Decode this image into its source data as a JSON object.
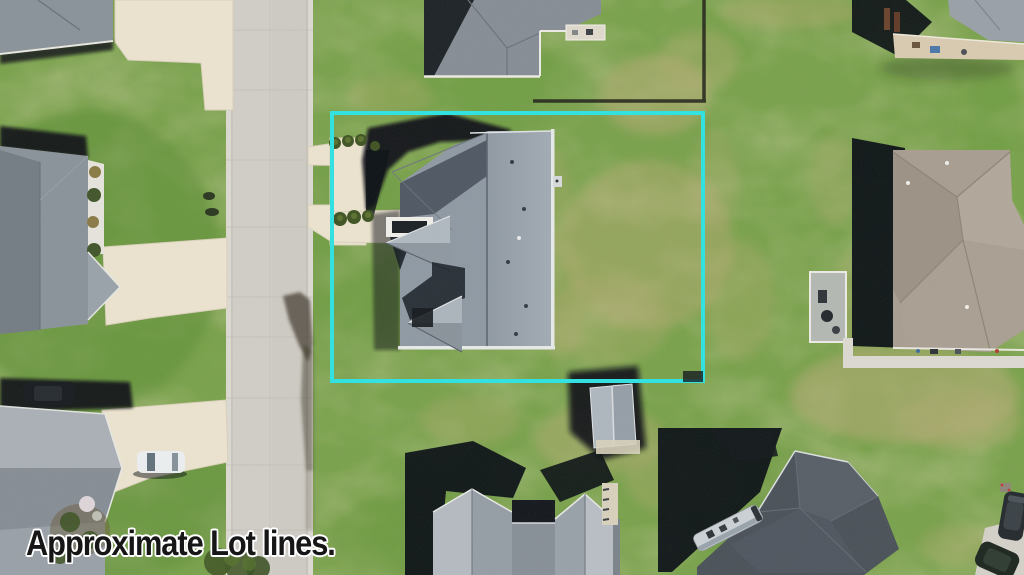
{
  "image": {
    "type": "aerial-drone-photograph",
    "caption": "Approximate Lot lines.",
    "lot_boundary": {
      "shape": "rectangle",
      "color": "#2de2e2"
    },
    "scene_objects": [
      "street",
      "subject-house",
      "subject-lot-yard",
      "storage-shed",
      "neighbor-house-top-left",
      "neighbor-house-left",
      "neighbor-house-bottom-left",
      "neighbor-house-top",
      "neighbor-house-top-right",
      "neighbor-house-right",
      "neighbor-house-bottom-center",
      "neighbor-house-bottom-right",
      "white-car",
      "dark-car",
      "rv-camper",
      "parked-suv",
      "parked-car",
      "backyard-fence",
      "street-tree",
      "shrub-rows",
      "driveways"
    ],
    "colors": {
      "lot_line": "#2de2e2",
      "caption_text": "#161616",
      "caption_outline": "#ffffff",
      "grass_base": "#79a24b",
      "grass_patch": "#b5ab74",
      "street_concrete": "#cecbc4",
      "driveway_concrete": "#ece4cf",
      "subject_roof": "#9aa3ad",
      "dark_roof": "#4a5158",
      "taupe_roof": "#a79d90",
      "shadow": "#0a0f14"
    }
  }
}
